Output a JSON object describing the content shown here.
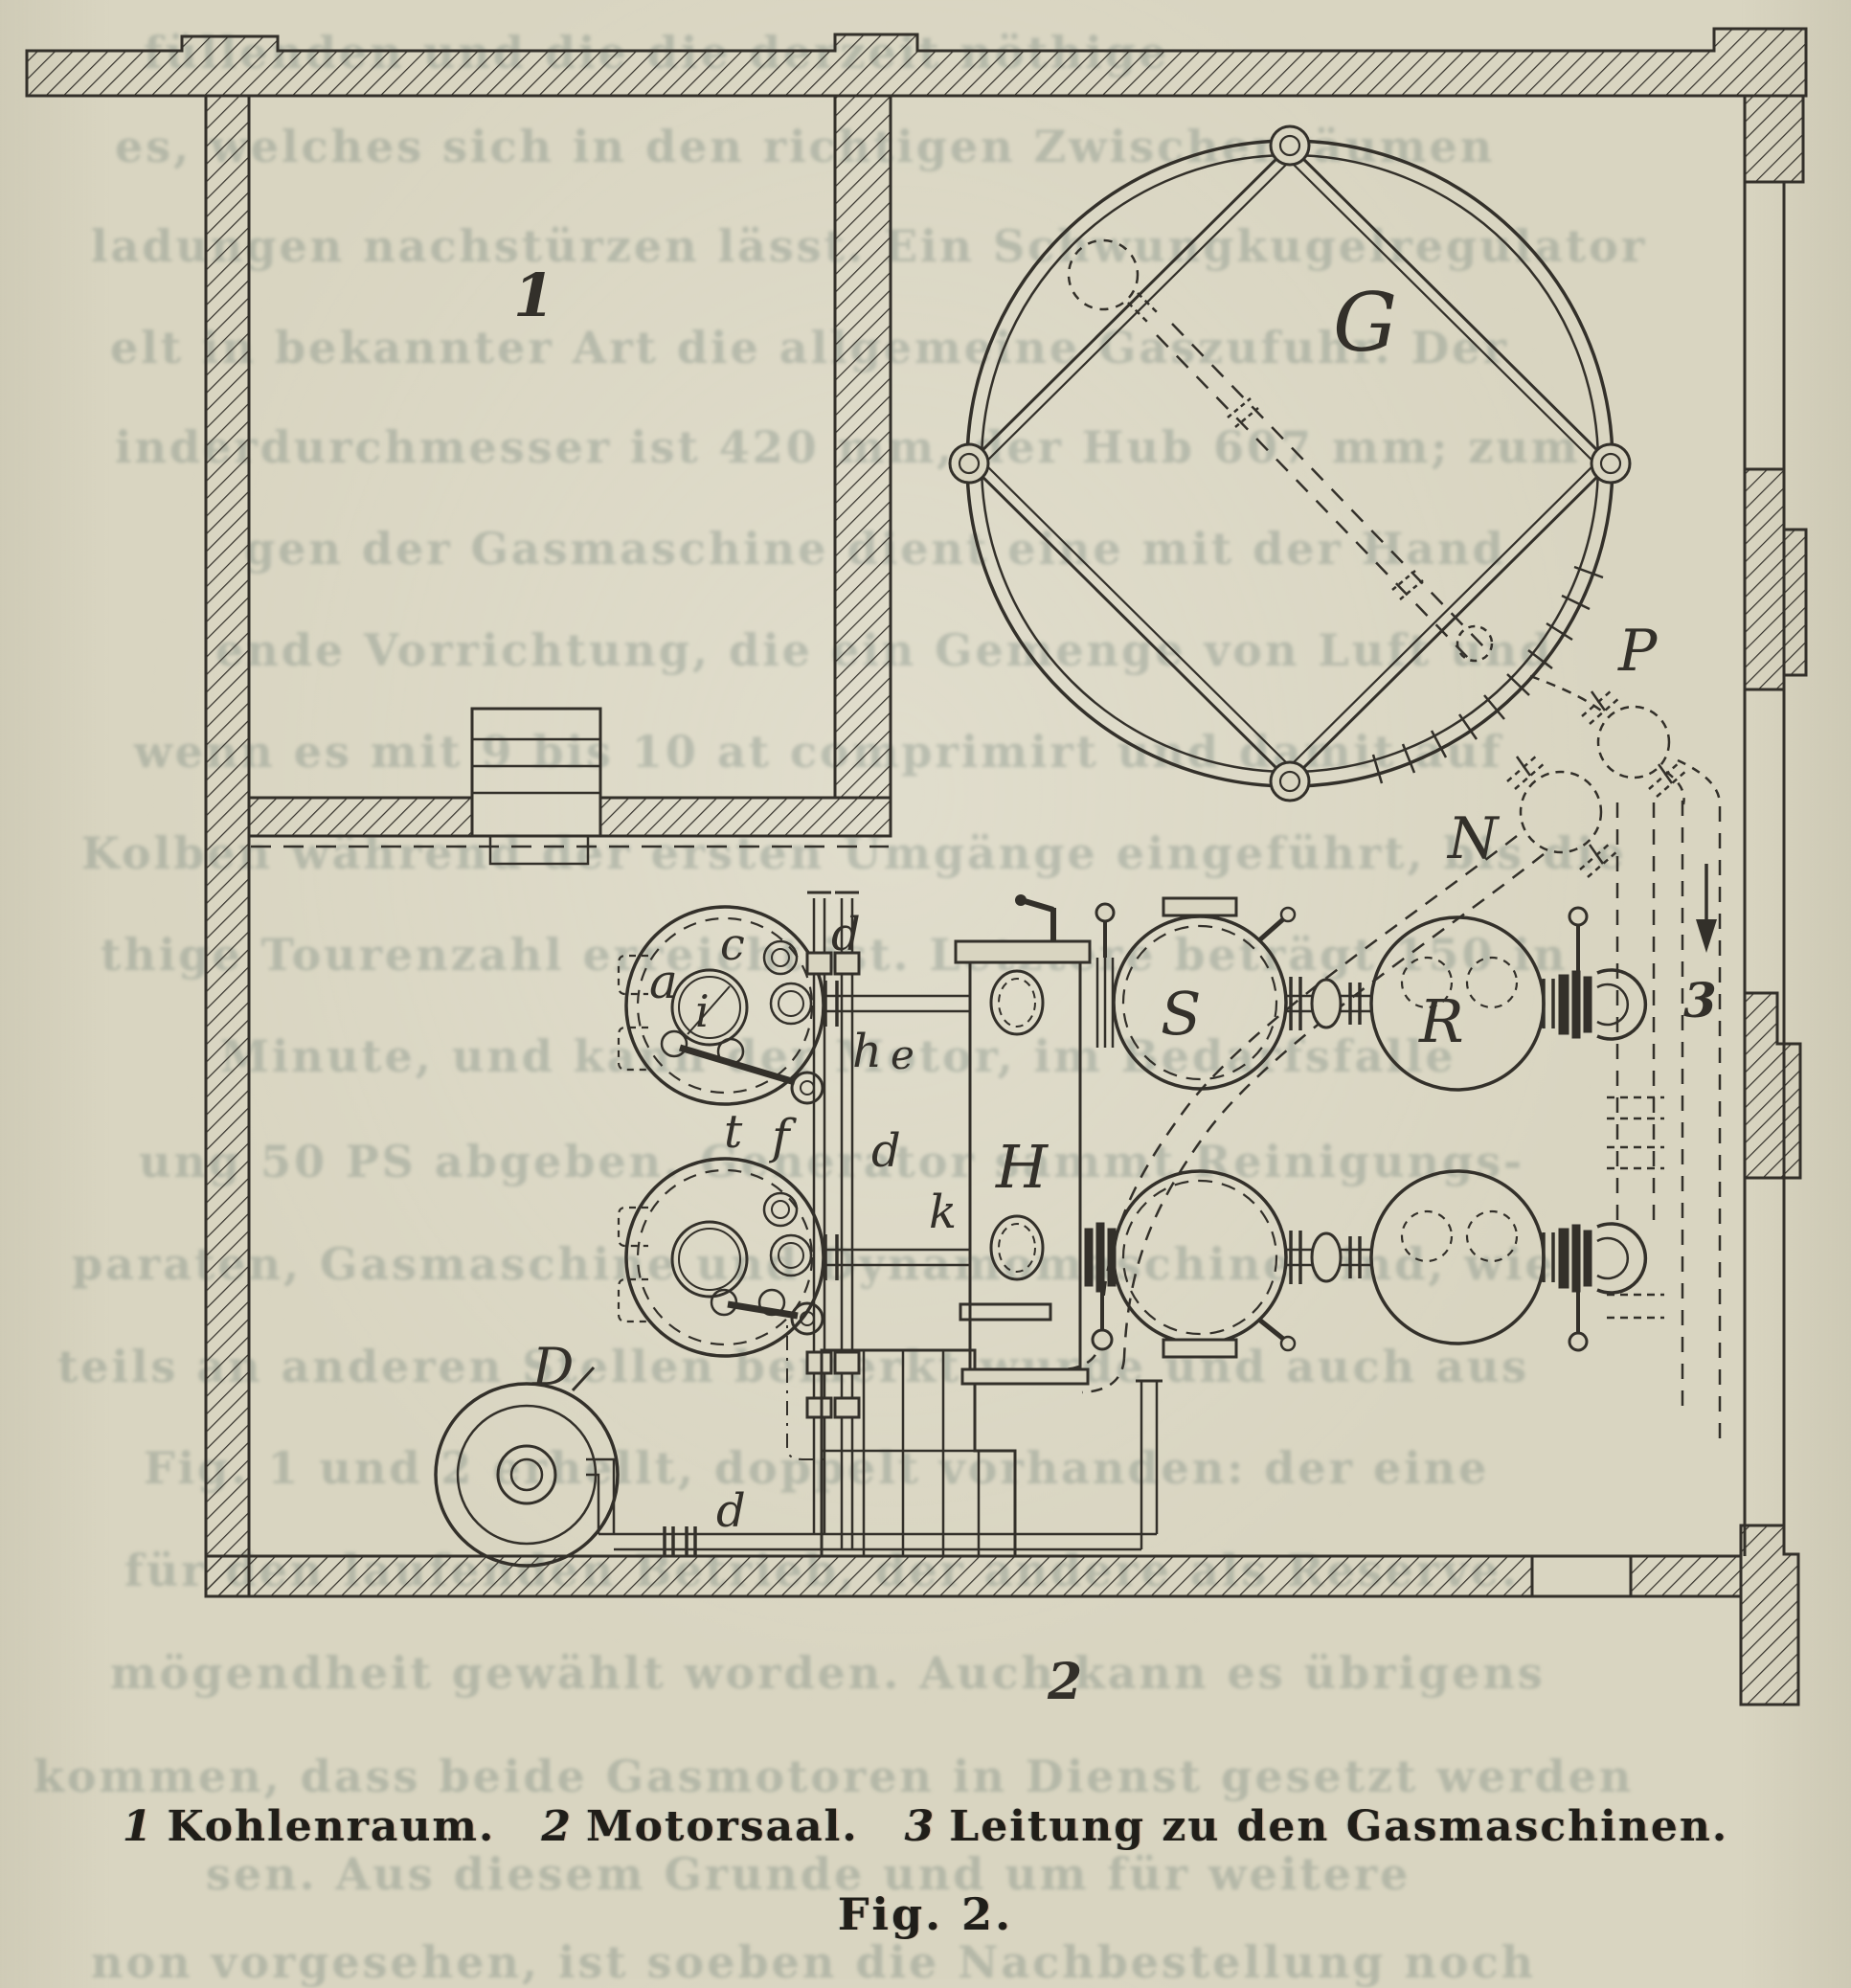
{
  "figure": {
    "caption_items": [
      {
        "num": "1",
        "label": "Kohlenraum."
      },
      {
        "num": "2",
        "label": "Motorsaal."
      },
      {
        "num": "3",
        "label": "Leitung zu den Gasmaschinen."
      }
    ],
    "fig_label": "Fig. 2.",
    "labels": {
      "room1": "1",
      "room2": "2",
      "pipe3": "3",
      "G": "G",
      "P": "P",
      "N": "N",
      "S": "S",
      "R": "R",
      "H": "H",
      "a": "a",
      "c": "c",
      "i": "i",
      "h": "h",
      "e": "e",
      "d_top": "d",
      "t": "t",
      "f": "f",
      "d_mid": "d",
      "k": "k",
      "D": "D",
      "d_bottom": "d"
    },
    "colors": {
      "paper": "#d9d5c1",
      "ink": "#33302a",
      "ghost_text": "#748077"
    }
  },
  "ghost_lines": [
    "füllenden und     die die derzeit nöthige",
    "es, welches sich in den richtigen Zwischenräumen",
    "ladungen nachstürzen lässt. Ein Schwungkugelregulator",
    "elt in bekannter Art die allgemeine Gaszufuhr. Der",
    "inderdurchmesser ist 420 mm, der Hub 607 mm; zum",
    "gen der Gasmaschine dient eine mit der Hand",
    "ende Vorrichtung, die ein Gemenge von Luft und",
    "wenn es mit 9 bis 10 at comprimirt und damit auf",
    "Kolben während der ersten Umgänge eingeführt, bis die",
    "thige Tourenzahl erreicht ist. Letztere beträgt 150 in",
    "Minute, und kann der Motor, im Bedarfsfalle",
    "ung 50 PS abgeben. Generator sammt Reinigungs-",
    "paraten, Gasmaschine und Dynamomaschine sind, wie",
    "teils an anderen Stellen bemerkt wurde und auch aus",
    "Fig. 1 und 2 erhellt, doppelt vorhanden: der eine",
    "für den laufenden Betrieb, der andere als Reserve.",
    "mögendheit gewählt worden. Auch kann es übrigens",
    "kommen, dass beide Gasmotoren in Dienst gesetzt werden",
    "sen. Aus diesem Grunde und um für weitere",
    "non vorgesehen, ist soeben die Nachbestellung noch"
  ]
}
